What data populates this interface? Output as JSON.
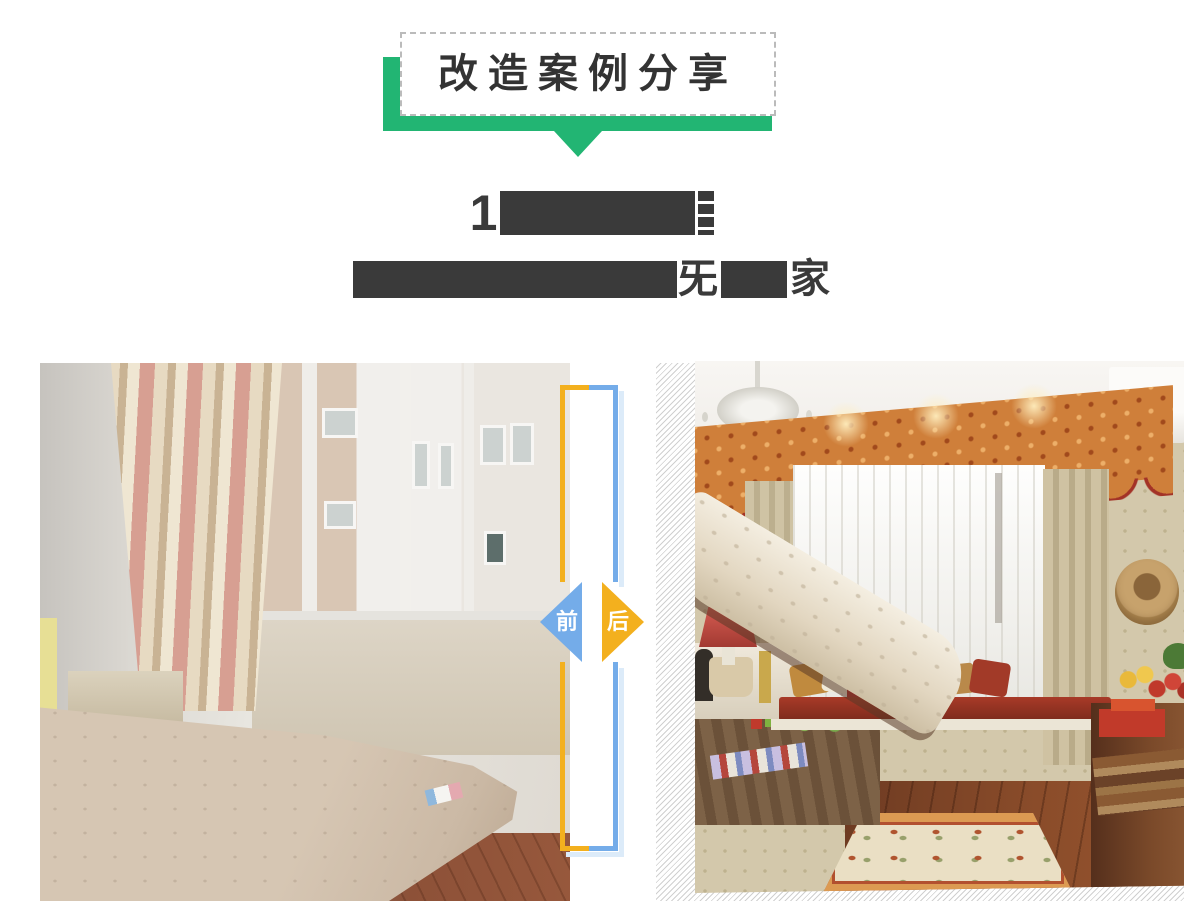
{
  "colors": {
    "green": "#22b573",
    "blue": "#74ace9",
    "orange": "#f3b01e",
    "shadow_blue": "#dcebf9",
    "redaction": "#3a3a3a",
    "hatch": "#d0d0d0",
    "heading_text": "#333333",
    "dashed_border": "#bbbbbb"
  },
  "banner": {
    "title": "改造案例分享"
  },
  "heading": {
    "title_prefix": "1",
    "subtitle_fragment_1": "旡",
    "subtitle_fragment_2": "家"
  },
  "divider": {
    "before_label": "前",
    "after_label": "后"
  }
}
